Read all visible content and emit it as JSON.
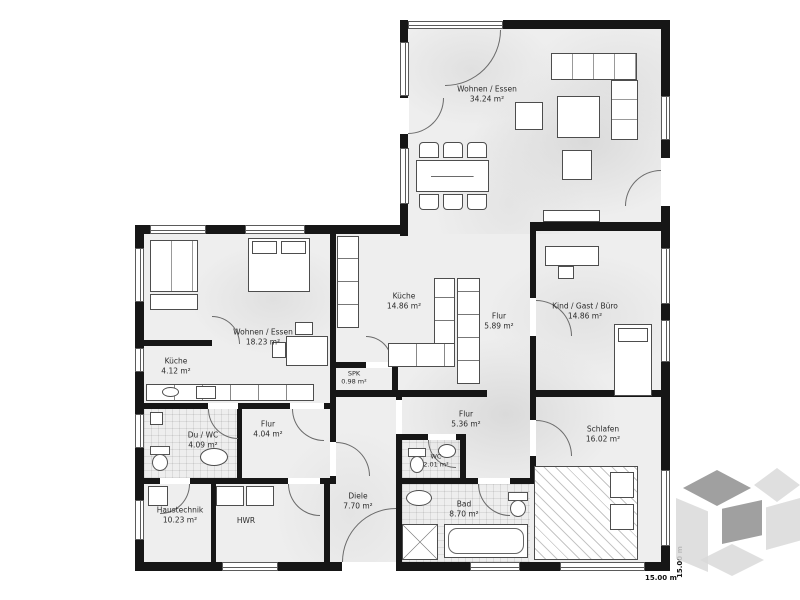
{
  "plan": {
    "rooms": [
      {
        "id": "wohnen-essen-haupt",
        "name": "Wohnen / Essen",
        "area": "34.24 m²"
      },
      {
        "id": "wohnen-essen-elw",
        "name": "Wohnen / Essen",
        "area": "18.23 m²"
      },
      {
        "id": "kueche-elw",
        "name": "Küche",
        "area": "4.12 m²"
      },
      {
        "id": "kueche",
        "name": "Küche",
        "area": "14.86 m²"
      },
      {
        "id": "spk",
        "name": "SPK",
        "area": "0.98 m²"
      },
      {
        "id": "flur-nord",
        "name": "Flur",
        "area": "5.89 m²"
      },
      {
        "id": "kind-gast-buero",
        "name": "Kind / Gast / Büro",
        "area": "14.86 m²"
      },
      {
        "id": "du-wc",
        "name": "Du / WC",
        "area": "4.09 m²"
      },
      {
        "id": "flur-elw",
        "name": "Flur",
        "area": "4.04 m²"
      },
      {
        "id": "haustechnik",
        "name": "Haustechnik",
        "area": "10.23 m²"
      },
      {
        "id": "hwr",
        "name": "HWR",
        "area": ""
      },
      {
        "id": "diele",
        "name": "Diele",
        "area": "7.70 m²"
      },
      {
        "id": "wc",
        "name": "WC",
        "area": "2.01 m²"
      },
      {
        "id": "flur-sued",
        "name": "Flur",
        "area": "5.36 m²"
      },
      {
        "id": "bad",
        "name": "Bad",
        "area": "8.70 m²"
      },
      {
        "id": "schlafen",
        "name": "Schlafen",
        "area": "16.02 m²"
      }
    ],
    "dimensions": {
      "width": "15.00 m",
      "height": "15.00 m"
    },
    "colors": {
      "wall": "#161616",
      "floor": "#eeeeee",
      "watermark_light": "#d9d9d9",
      "watermark_dark": "#8f8f8f"
    }
  }
}
